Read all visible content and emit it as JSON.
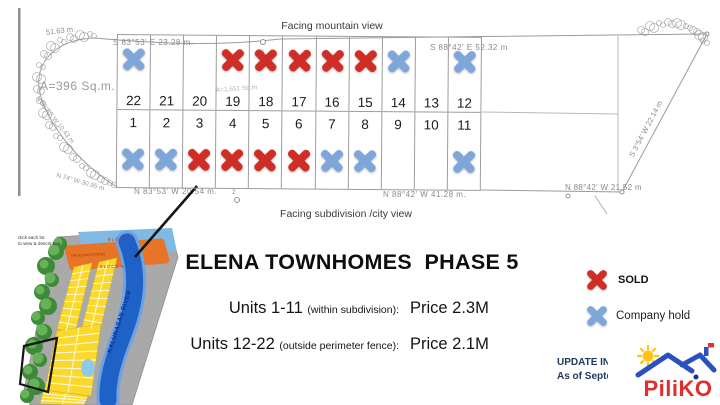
{
  "colors": {
    "sold": "#cf2e27",
    "hold": "#7fa6d9",
    "navy": "#1f3864",
    "brand_red": "#e02d2d",
    "roof_blue": "#2a52be",
    "sun_yellow": "#ffc20e"
  },
  "plat": {
    "facing_top": "Facing mountain view",
    "facing_bottom": "Facing subdivision /city view",
    "area_labels": {
      "left": "A=396  Sq.m.",
      "lot19": "A=1,651 Sq.m"
    },
    "bearings": {
      "top_left": "S 83°53' E   23.28 m.",
      "top_right": "S 88°42' E   52.32 m",
      "bottom_left": "N 83°53' W   20.54 m.",
      "bottom_mid": "N 88°42' W   41.28 m.",
      "bottom_right": "N 88°42' W 21.52 m",
      "right_diagonal": "S 3°54' W  22.14 m",
      "left_top": "51.63 m.",
      "left_arc_1": "N 83°52' W  10.43 m",
      "left_arc_2": "N 74°  W  30.95 m"
    },
    "markers": {
      "top": "16",
      "bottom": "2"
    },
    "top_row": [
      {
        "num": "22",
        "status": "hold"
      },
      {
        "num": "21",
        "status": "none"
      },
      {
        "num": "20",
        "status": "none"
      },
      {
        "num": "19",
        "status": "sold"
      },
      {
        "num": "18",
        "status": "sold"
      },
      {
        "num": "17",
        "status": "sold"
      },
      {
        "num": "16",
        "status": "sold"
      },
      {
        "num": "15",
        "status": "sold"
      },
      {
        "num": "14",
        "status": "hold"
      },
      {
        "num": "13",
        "status": "none"
      },
      {
        "num": "12",
        "status": "hold"
      }
    ],
    "bottom_row": [
      {
        "num": "1",
        "status": "hold"
      },
      {
        "num": "2",
        "status": "hold"
      },
      {
        "num": "3",
        "status": "sold"
      },
      {
        "num": "4",
        "status": "sold"
      },
      {
        "num": "5",
        "status": "sold"
      },
      {
        "num": "6",
        "status": "sold"
      },
      {
        "num": "7",
        "status": "hold"
      },
      {
        "num": "8",
        "status": "hold"
      },
      {
        "num": "9",
        "status": "none"
      },
      {
        "num": "10",
        "status": "none"
      },
      {
        "num": "11",
        "status": "hold"
      }
    ]
  },
  "map": {
    "caption_line1": "click each lot",
    "caption_line2": "to view & description",
    "block_label_top": "BLOCK 9",
    "block_label_bottom": "BLOCK 8",
    "orange_block_text": "THE ELENA ESTATES",
    "river_label": "KALUNASAN RIVER"
  },
  "info": {
    "title": "ELENA TOWNHOMES  PHASE 5",
    "rows": [
      {
        "units": "Units 1-11 ",
        "qualifier": "(within subdivision):",
        "price": "Price 2.3M"
      },
      {
        "units": "Units 12-22 ",
        "qualifier": "(outside perimeter fence):",
        "price": "Price 2.1M"
      }
    ]
  },
  "legend": {
    "sold": "SOLD",
    "hold": "Company hold"
  },
  "footer": {
    "line1": "UPDATE INVE",
    "line2": "As of Septem",
    "brand": "PiliKO"
  }
}
